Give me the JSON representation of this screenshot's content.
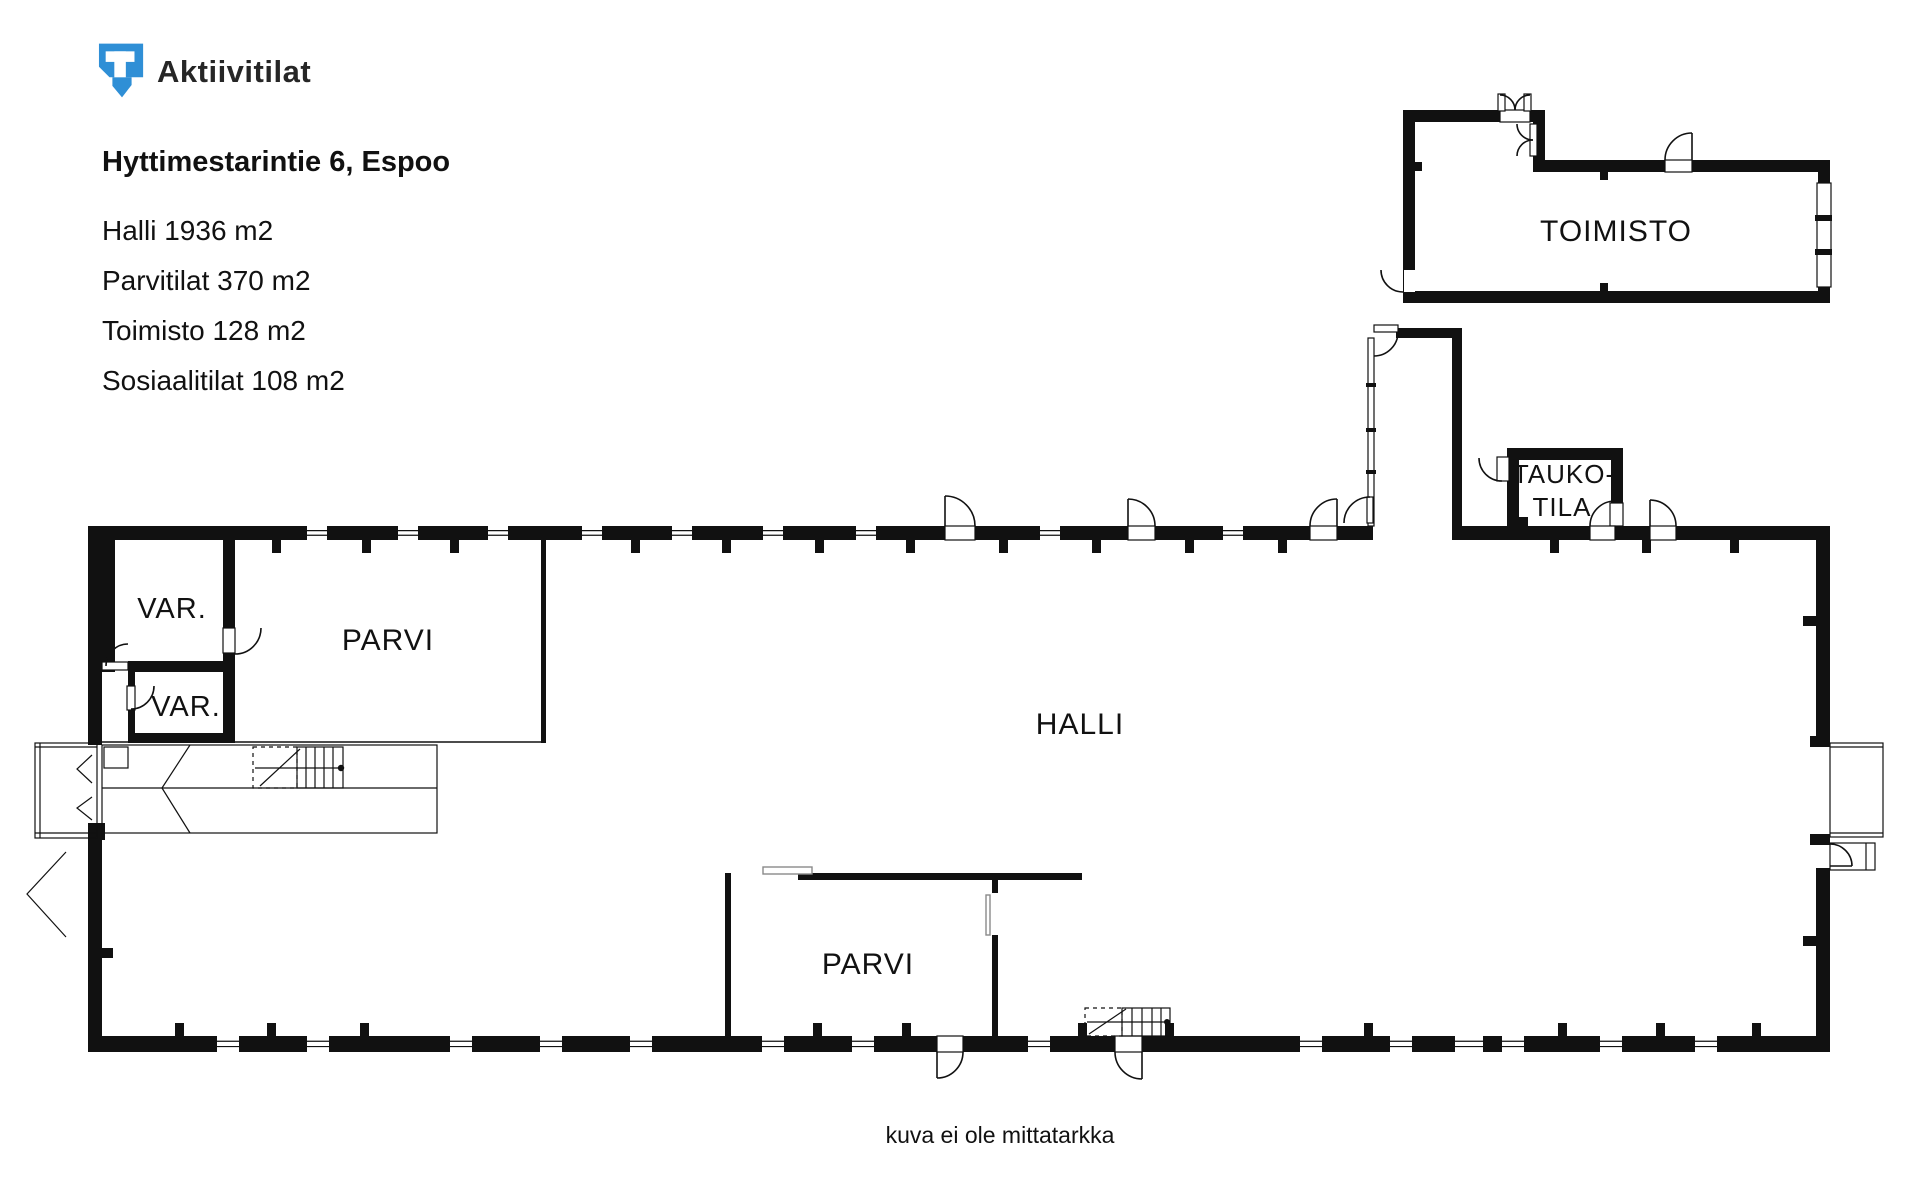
{
  "brand": {
    "name": "Aktiivitilat"
  },
  "listing": {
    "address": "Hyttimestarintie 6, Espoo",
    "areas": [
      "Halli 1936 m2",
      "Parvitilat 370 m2",
      "Toimisto 128 m2",
      "Sosiaalitilat 108 m2"
    ]
  },
  "floor_plan": {
    "labels": {
      "toimisto": "TOIMISTO",
      "taukotila_line1": "TAUKO-",
      "taukotila_line2": "TILA",
      "var_upper": "VAR.",
      "var_lower": "VAR.",
      "parvi_upper": "PARVI",
      "parvi_lower": "PARVI",
      "halli": "HALLI"
    }
  },
  "footer": {
    "disclaimer": "kuva ei ole mittatarkka"
  },
  "colors": {
    "brand_blue": "#2F8FD6",
    "ink": "#1F1F1F"
  }
}
